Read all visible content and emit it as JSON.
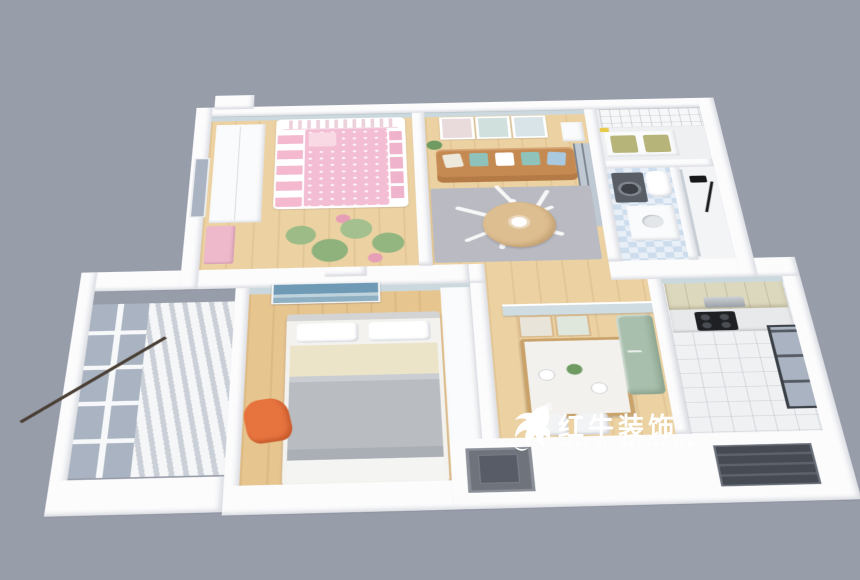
{
  "background_color": "#989daa",
  "watermark": {
    "brand_cn": "红牛装饰",
    "brand_en": "HONG NIU DECORATION",
    "registered_mark": "®",
    "text_color": "#ffffff",
    "icon": "bull-logo-icon"
  },
  "palette": {
    "wall_white": "#fcfcfd",
    "wall_face_blue": "#cbd9de",
    "floor_wood_light": "#ecd2a2",
    "floor_wood_bedroom": "#e7c58f",
    "bathroom_tile_blue": "#cddded",
    "glass_gray": "#a9b3c1",
    "sofa_tan": "#c58a52",
    "pillow_teal": "#8fc2ba",
    "bunk_bed_pink": "#f3bed4",
    "rug_gray": "#b4b5bd",
    "cactus_green": "#9cbb86",
    "fridge_sage": "#a9bfad",
    "kitchen_cabinet_cream": "#dcd8bd",
    "cooktop_black": "#1e2023",
    "chair_orange": "#e7743f",
    "bench_cushion_olive": "#b6b478",
    "door_recess_gray": "#6e737c",
    "window_recess_dark": "#464b53"
  },
  "floor_plan": {
    "style": "isometric-cutaway-3d-render",
    "rooms": [
      {
        "name": "kids-bedroom",
        "furniture": [
          "wardrobe",
          "bunk-bed",
          "cactus-rug",
          "pink-dresser",
          "window"
        ]
      },
      {
        "name": "living-room",
        "furniture": [
          "three-wall-frames",
          "tan-sofa",
          "throw-pillows",
          "leaf-rug",
          "round-coffee-table",
          "plant",
          "glass-partition",
          "console"
        ]
      },
      {
        "name": "entry-storage",
        "furniture": [
          "lattice-cabinet",
          "bench",
          "olive-cushions"
        ]
      },
      {
        "name": "bathroom",
        "furniture": [
          "washing-machine",
          "vanity",
          "toilet",
          "diamond-tile-walls"
        ]
      },
      {
        "name": "shower-room",
        "furniture": [
          "shower-set",
          "glass-door"
        ]
      },
      {
        "name": "balcony",
        "furniture": [
          "glazed-windows",
          "curtain-slats",
          "drying-pole"
        ]
      },
      {
        "name": "master-bedroom",
        "furniture": [
          "double-bed",
          "seascape-art",
          "closet",
          "orange-chair",
          "curtain"
        ]
      },
      {
        "name": "dining-area",
        "furniture": [
          "half-wall-frames",
          "marble-dining-table",
          "two-chairs",
          "refrigerator",
          "flowers"
        ]
      },
      {
        "name": "kitchen",
        "furniture": [
          "upper-cabinets",
          "range-hood",
          "cooktop",
          "counter",
          "window"
        ]
      }
    ],
    "exterior_features": [
      "chimney-bump",
      "front-door-recess",
      "front-window-recess",
      "mid-roof-band",
      "ac-box"
    ]
  }
}
